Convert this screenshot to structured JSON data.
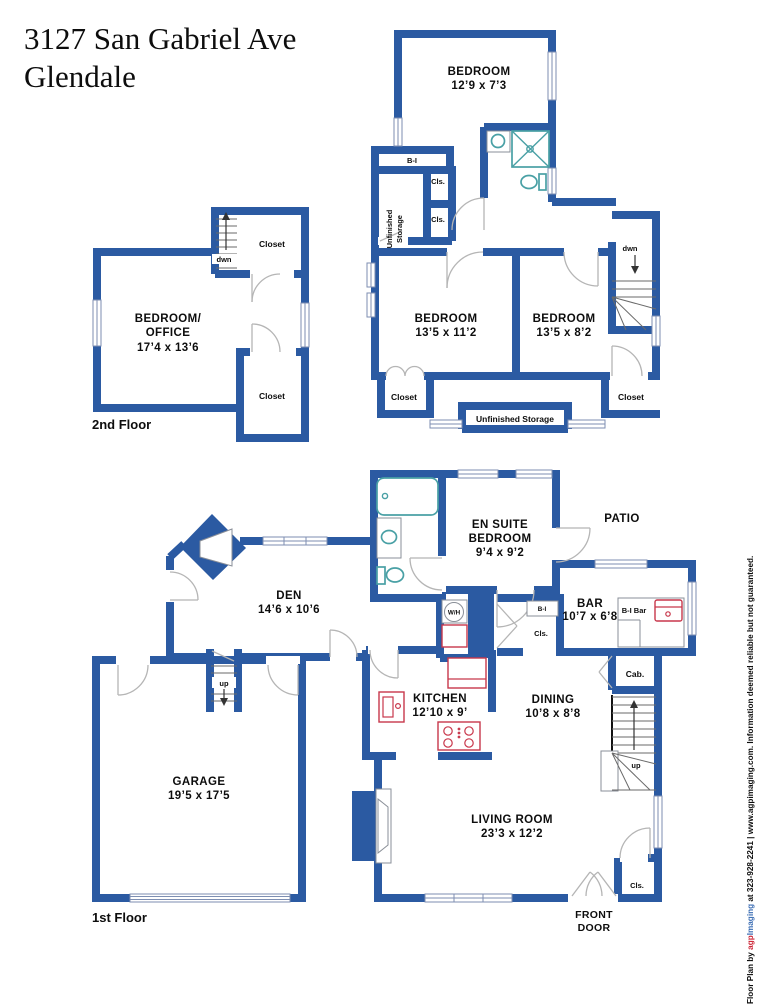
{
  "title": {
    "line1": "3127 San Gabriel Ave",
    "line2": "Glendale"
  },
  "colors": {
    "wall": "#2b5aa2",
    "fixture": "#49a0a5",
    "appliance": "#c8374b",
    "text": "#0d0d0d",
    "brand_red": "#cc2233",
    "brand_blue": "#3a6cb3"
  },
  "floor2": {
    "label": "2nd Floor",
    "bedroom_top": {
      "name": "BEDROOM",
      "dims": "12’9 x 7’3"
    },
    "bedroom_left": {
      "name": "BEDROOM",
      "dims": "13’5 x 11’2"
    },
    "bedroom_right": {
      "name": "BEDROOM",
      "dims": "13’5 x 8’2"
    },
    "bedroom_office": {
      "name1": "BEDROOM/",
      "name2": "OFFICE",
      "dims": "17’4 x 13’6"
    },
    "closet_office_top": "Closet",
    "closet_office_bottom": "Closet",
    "closet_left": "Closet",
    "closet_right": "Closet",
    "storage_vert1": "Unfinished",
    "storage_vert2": "Storage",
    "storage_bottom": "Unfinished Storage",
    "bi": "B-I",
    "cls1": "Cls.",
    "cls2": "Cls.",
    "dwn_left": "dwn",
    "dwn_right": "dwn"
  },
  "floor1": {
    "label": "1st Floor",
    "den": {
      "name": "DEN",
      "dims": "14’6 x 10’6"
    },
    "ensuite": {
      "name1": "EN SUITE",
      "name2": "BEDROOM",
      "dims": "9’4 x 9’2"
    },
    "patio": "PATIO",
    "bar": {
      "name": "BAR",
      "dims": "10’7 x 6’8"
    },
    "bi_bar": "B-I Bar",
    "bi_hall": "B-I",
    "cls_hall": "Cls.",
    "cab": "Cab.",
    "wh": "W/H",
    "kitchen": {
      "name": "KITCHEN",
      "dims": "12’10 x 9’"
    },
    "dining": {
      "name": "DINING",
      "dims": "10’8 x 8’8"
    },
    "garage": {
      "name": "GARAGE",
      "dims": "19’5 x 17’5"
    },
    "living": {
      "name": "LIVING ROOM",
      "dims": "23’3 x 12’2"
    },
    "front_door1": "FRONT",
    "front_door2": "DOOR",
    "cls_front": "Cls.",
    "up_mid": "up",
    "up_right": "up"
  },
  "watermark": {
    "prefix": "Floor Plan by ",
    "brand_a": "agp",
    "brand_b": "Imaging",
    "suffix": " at 323-928-2241 | www.agpimaging.com. Information deemed reliable but not guaranteed."
  }
}
